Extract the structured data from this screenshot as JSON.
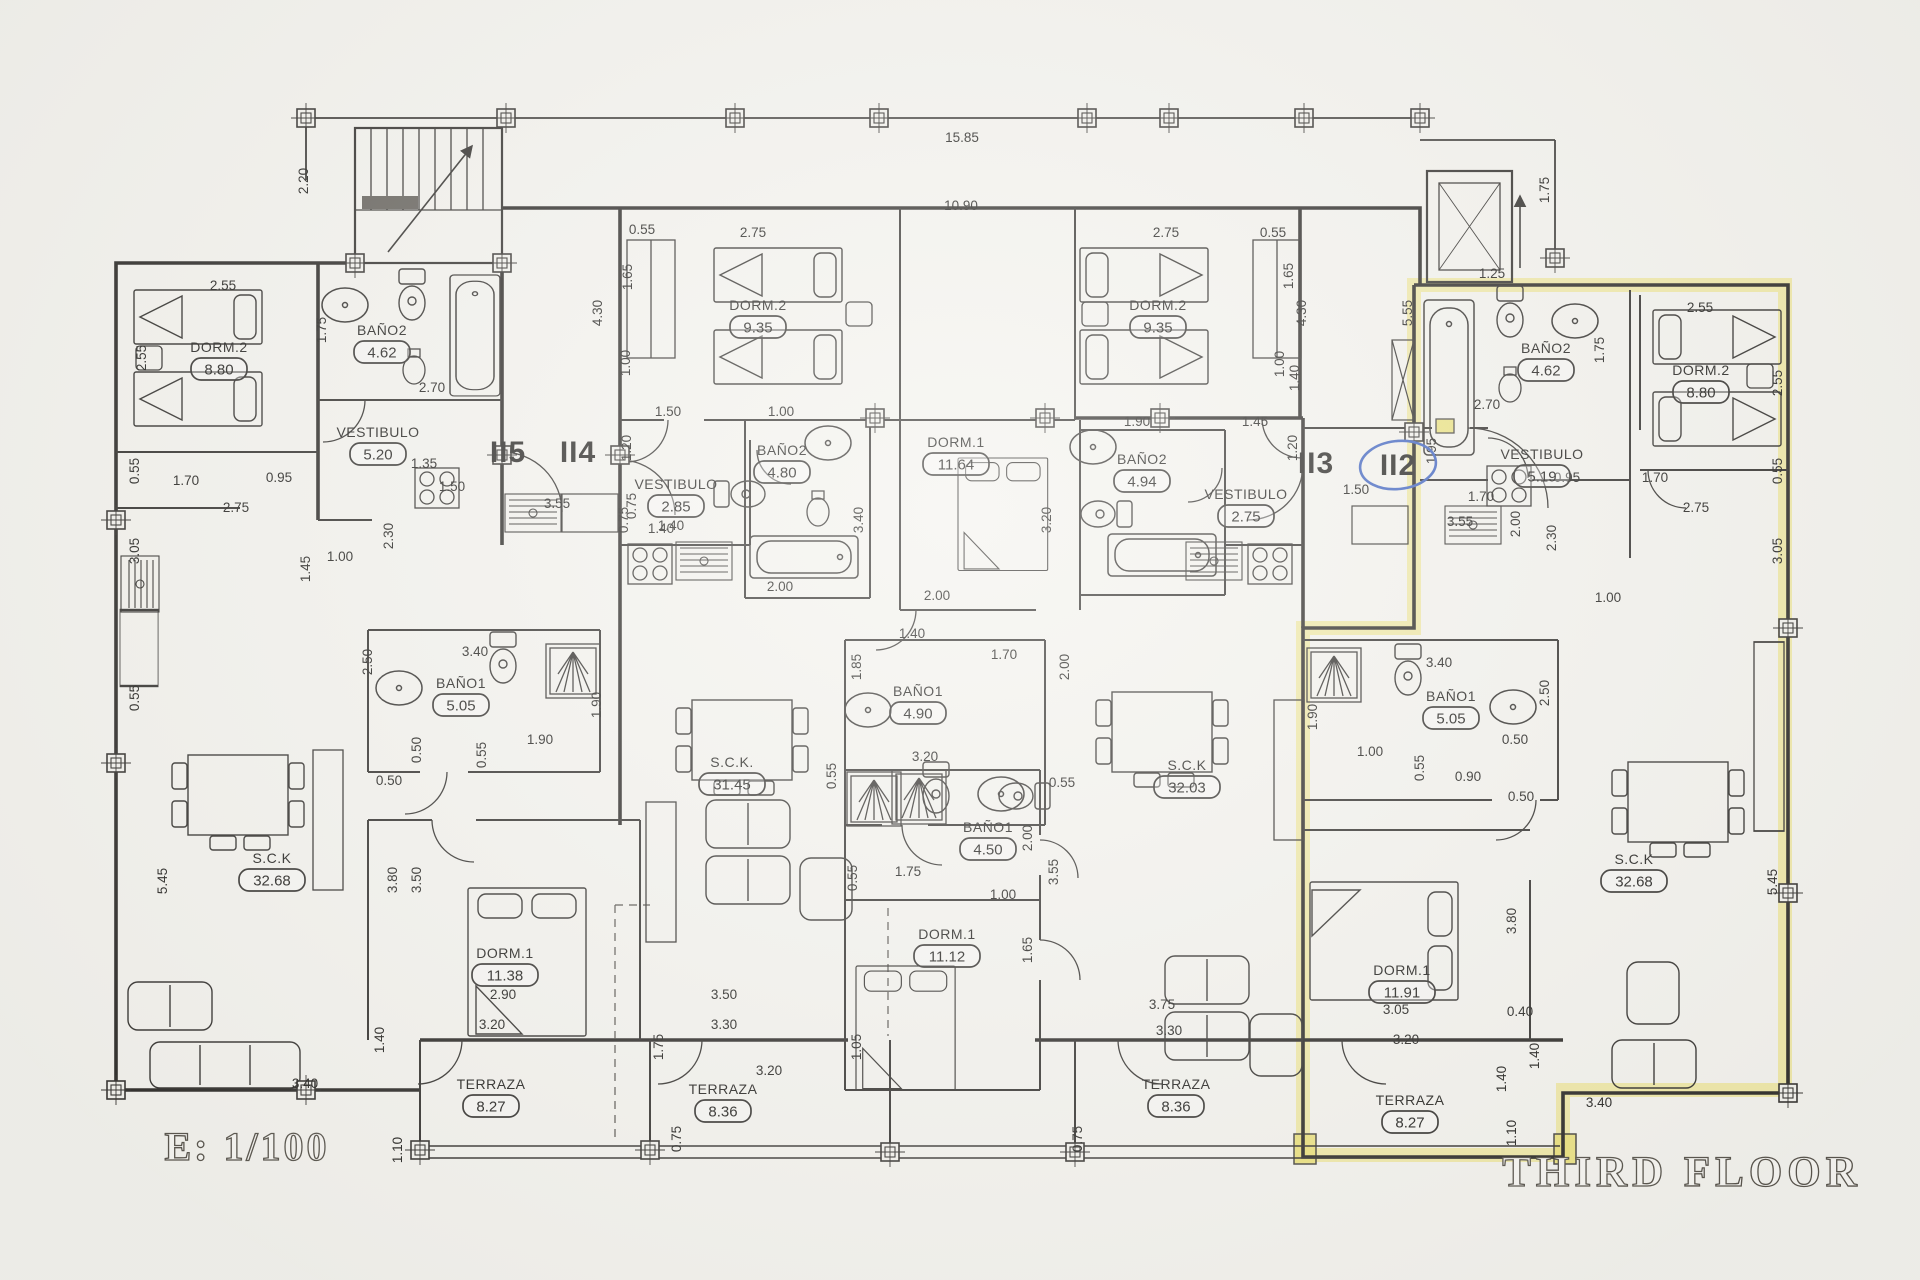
{
  "titles": {
    "scale_label": "E: 1/100",
    "floor_label": "THIRD FLOOR"
  },
  "units": [
    {
      "id": "II5",
      "x": 508,
      "y": 452,
      "circled": false
    },
    {
      "id": "II4",
      "x": 578,
      "y": 452,
      "circled": false
    },
    {
      "id": "II3",
      "x": 1316,
      "y": 463,
      "circled": false
    },
    {
      "id": "II2",
      "x": 1398,
      "y": 465,
      "circled": true
    }
  ],
  "rooms": [
    {
      "apt": "II5",
      "name": "DORM.2",
      "area": "8.80",
      "x": 219,
      "y": 348
    },
    {
      "apt": "II5",
      "name": "BAÑO2",
      "area": "4.62",
      "x": 382,
      "y": 331
    },
    {
      "apt": "II5",
      "name": "VESTIBULO",
      "area": "5.20",
      "x": 378,
      "y": 433
    },
    {
      "apt": "II5",
      "name": "BAÑO1",
      "area": "5.05",
      "x": 461,
      "y": 684
    },
    {
      "apt": "II5",
      "name": "S.C.K",
      "area": "32.68",
      "x": 272,
      "y": 859
    },
    {
      "apt": "II5",
      "name": "DORM.1",
      "area": "11.38",
      "x": 505,
      "y": 954
    },
    {
      "apt": "II5",
      "name": "TERRAZA",
      "area": "8.27",
      "x": 491,
      "y": 1085
    },
    {
      "apt": "II4",
      "name": "DORM.2",
      "area": "9.35",
      "x": 758,
      "y": 306
    },
    {
      "apt": "II4",
      "name": "VESTIBULO",
      "area": "2.85",
      "x": 676,
      "y": 485
    },
    {
      "apt": "II4",
      "name": "BAÑO2",
      "area": "4.80",
      "x": 782,
      "y": 451
    },
    {
      "apt": "II4",
      "name": "DORM.1",
      "area": "11.64",
      "x": 956,
      "y": 443
    },
    {
      "apt": "II4",
      "name": "BAÑO1",
      "area": "4.90",
      "x": 918,
      "y": 692
    },
    {
      "apt": "II4",
      "name": "S.C.K.",
      "area": "31.45",
      "x": 732,
      "y": 763
    },
    {
      "apt": "II4",
      "name": "TERRAZA",
      "area": "8.36",
      "x": 723,
      "y": 1090
    },
    {
      "apt": "II3",
      "name": "DORM.2",
      "area": "9.35",
      "x": 1158,
      "y": 306
    },
    {
      "apt": "II3",
      "name": "BAÑO2",
      "area": "4.94",
      "x": 1142,
      "y": 460
    },
    {
      "apt": "II3",
      "name": "VESTIBULO",
      "area": "2.75",
      "x": 1246,
      "y": 495
    },
    {
      "apt": "II3",
      "name": "BAÑO1",
      "area": "4.50",
      "x": 988,
      "y": 828
    },
    {
      "apt": "II3",
      "name": "DORM.1",
      "area": "11.12",
      "x": 947,
      "y": 935
    },
    {
      "apt": "II3",
      "name": "S.C.K",
      "area": "32.03",
      "x": 1187,
      "y": 766
    },
    {
      "apt": "II3",
      "name": "TERRAZA",
      "area": "8.36",
      "x": 1176,
      "y": 1085
    },
    {
      "apt": "II2",
      "name": "BAÑO2",
      "area": "4.62",
      "x": 1546,
      "y": 349
    },
    {
      "apt": "II2",
      "name": "DORM.2",
      "area": "8.80",
      "x": 1701,
      "y": 371
    },
    {
      "apt": "II2",
      "name": "VESTIBULO",
      "area": "5.19",
      "x": 1542,
      "y": 455
    },
    {
      "apt": "II2",
      "name": "BAÑO1",
      "area": "5.05",
      "x": 1451,
      "y": 697
    },
    {
      "apt": "II2",
      "name": "DORM.1",
      "area": "11.91",
      "x": 1402,
      "y": 971
    },
    {
      "apt": "II2",
      "name": "S.C.K",
      "area": "32.68",
      "x": 1634,
      "y": 860
    },
    {
      "apt": "II2",
      "name": "TERRAZA",
      "area": "8.27",
      "x": 1410,
      "y": 1101
    }
  ],
  "dimensions": [
    {
      "t": "15.85",
      "x": 962,
      "y": 138
    },
    {
      "t": "10.90",
      "x": 961,
      "y": 206
    },
    {
      "t": "2.20",
      "x": 304,
      "y": 181,
      "v": 1
    },
    {
      "t": "1.75",
      "x": 1545,
      "y": 190,
      "v": 1
    },
    {
      "t": "1.25",
      "x": 1492,
      "y": 274
    },
    {
      "t": "2.55",
      "x": 223,
      "y": 286
    },
    {
      "t": "2.55",
      "x": 142,
      "y": 358,
      "v": 1
    },
    {
      "t": "1.75",
      "x": 322,
      "y": 330,
      "v": 1
    },
    {
      "t": "2.70",
      "x": 432,
      "y": 388
    },
    {
      "t": "0.95",
      "x": 279,
      "y": 478
    },
    {
      "t": "1.70",
      "x": 186,
      "y": 481
    },
    {
      "t": "0.55",
      "x": 135,
      "y": 471,
      "v": 1
    },
    {
      "t": "2.75",
      "x": 236,
      "y": 508
    },
    {
      "t": "3.05",
      "x": 135,
      "y": 551,
      "v": 1
    },
    {
      "t": "1.45",
      "x": 306,
      "y": 569,
      "v": 1
    },
    {
      "t": "1.00",
      "x": 340,
      "y": 557
    },
    {
      "t": "0.55",
      "x": 135,
      "y": 698,
      "v": 1
    },
    {
      "t": "5.45",
      "x": 163,
      "y": 881,
      "v": 1
    },
    {
      "t": "3.40",
      "x": 305,
      "y": 1084
    },
    {
      "t": "1.10",
      "x": 398,
      "y": 1150,
      "v": 1
    },
    {
      "t": "1.40",
      "x": 380,
      "y": 1040,
      "v": 1
    },
    {
      "t": "2.30",
      "x": 389,
      "y": 536,
      "v": 1
    },
    {
      "t": "3.55",
      "x": 557,
      "y": 504
    },
    {
      "t": "0.75",
      "x": 624,
      "y": 520,
      "v": 1
    },
    {
      "t": "1.40",
      "x": 661,
      "y": 529
    },
    {
      "t": "1.35",
      "x": 424,
      "y": 464
    },
    {
      "t": "1.50",
      "x": 452,
      "y": 487
    },
    {
      "t": "2.50",
      "x": 368,
      "y": 662,
      "v": 1
    },
    {
      "t": "3.40",
      "x": 475,
      "y": 652
    },
    {
      "t": "1.90",
      "x": 597,
      "y": 705,
      "v": 1
    },
    {
      "t": "0.50",
      "x": 417,
      "y": 750,
      "v": 1
    },
    {
      "t": "1.90",
      "x": 540,
      "y": 740
    },
    {
      "t": "0.55",
      "x": 482,
      "y": 755,
      "v": 1
    },
    {
      "t": "0.50",
      "x": 389,
      "y": 781
    },
    {
      "t": "3.80",
      "x": 393,
      "y": 880,
      "v": 1
    },
    {
      "t": "3.50",
      "x": 417,
      "y": 880,
      "v": 1
    },
    {
      "t": "2.90",
      "x": 503,
      "y": 995
    },
    {
      "t": "3.20",
      "x": 492,
      "y": 1025
    },
    {
      "t": "0.55",
      "x": 642,
      "y": 230
    },
    {
      "t": "2.75",
      "x": 753,
      "y": 233
    },
    {
      "t": "1.65",
      "x": 628,
      "y": 277,
      "v": 1
    },
    {
      "t": "4.30",
      "x": 598,
      "y": 313,
      "v": 1
    },
    {
      "t": "1.00",
      "x": 626,
      "y": 363,
      "v": 1
    },
    {
      "t": "1.50",
      "x": 668,
      "y": 412
    },
    {
      "t": "1.00",
      "x": 781,
      "y": 412
    },
    {
      "t": "1.20",
      "x": 627,
      "y": 448,
      "v": 1
    },
    {
      "t": "0.75",
      "x": 632,
      "y": 506,
      "v": 1
    },
    {
      "t": "1.40",
      "x": 671,
      "y": 526
    },
    {
      "t": "2.00",
      "x": 780,
      "y": 587
    },
    {
      "t": "3.40",
      "x": 859,
      "y": 520,
      "v": 1
    },
    {
      "t": "3.20",
      "x": 1047,
      "y": 520,
      "v": 1
    },
    {
      "t": "2.00",
      "x": 937,
      "y": 596
    },
    {
      "t": "1.40",
      "x": 912,
      "y": 634
    },
    {
      "t": "1.70",
      "x": 1004,
      "y": 655
    },
    {
      "t": "1.85",
      "x": 857,
      "y": 667,
      "v": 1
    },
    {
      "t": "2.00",
      "x": 1065,
      "y": 667,
      "v": 1
    },
    {
      "t": "3.20",
      "x": 925,
      "y": 757
    },
    {
      "t": "0.55",
      "x": 832,
      "y": 776,
      "v": 1
    },
    {
      "t": "1.75",
      "x": 908,
      "y": 872
    },
    {
      "t": "3.50",
      "x": 724,
      "y": 995
    },
    {
      "t": "3.30",
      "x": 724,
      "y": 1025
    },
    {
      "t": "1.75",
      "x": 659,
      "y": 1047,
      "v": 1
    },
    {
      "t": "1.05",
      "x": 857,
      "y": 1047,
      "v": 1
    },
    {
      "t": "3.20",
      "x": 769,
      "y": 1071
    },
    {
      "t": "0.75",
      "x": 677,
      "y": 1139,
      "v": 1
    },
    {
      "t": "2.75",
      "x": 1166,
      "y": 233
    },
    {
      "t": "0.55",
      "x": 1273,
      "y": 233
    },
    {
      "t": "1.65",
      "x": 1289,
      "y": 276,
      "v": 1
    },
    {
      "t": "4.30",
      "x": 1302,
      "y": 313,
      "v": 1
    },
    {
      "t": "1.00",
      "x": 1280,
      "y": 364,
      "v": 1
    },
    {
      "t": "1.90",
      "x": 1137,
      "y": 422
    },
    {
      "t": "1.45",
      "x": 1255,
      "y": 422
    },
    {
      "t": "1.40",
      "x": 1295,
      "y": 378,
      "v": 1
    },
    {
      "t": "1.20",
      "x": 1293,
      "y": 448,
      "v": 1
    },
    {
      "t": "0.55",
      "x": 1062,
      "y": 783
    },
    {
      "t": "2.00",
      "x": 1028,
      "y": 838,
      "v": 1
    },
    {
      "t": "3.55",
      "x": 1054,
      "y": 872,
      "v": 1
    },
    {
      "t": "0.55",
      "x": 853,
      "y": 878,
      "v": 1
    },
    {
      "t": "1.00",
      "x": 1003,
      "y": 895
    },
    {
      "t": "1.65",
      "x": 1028,
      "y": 950,
      "v": 1
    },
    {
      "t": "3.75",
      "x": 1162,
      "y": 1005
    },
    {
      "t": "3.30",
      "x": 1169,
      "y": 1031
    },
    {
      "t": "0.75",
      "x": 1078,
      "y": 1139,
      "v": 1
    },
    {
      "t": "5.55",
      "x": 1408,
      "y": 313,
      "v": 1
    },
    {
      "t": "2.70",
      "x": 1487,
      "y": 405
    },
    {
      "t": "1.75",
      "x": 1600,
      "y": 350,
      "v": 1
    },
    {
      "t": "2.55",
      "x": 1700,
      "y": 308
    },
    {
      "t": "2.55",
      "x": 1778,
      "y": 383,
      "v": 1
    },
    {
      "t": "0.95",
      "x": 1567,
      "y": 478
    },
    {
      "t": "1.70",
      "x": 1655,
      "y": 478
    },
    {
      "t": "0.55",
      "x": 1778,
      "y": 471,
      "v": 1
    },
    {
      "t": "2.00",
      "x": 1516,
      "y": 524,
      "v": 1
    },
    {
      "t": "2.75",
      "x": 1696,
      "y": 508
    },
    {
      "t": "3.05",
      "x": 1778,
      "y": 551,
      "v": 1
    },
    {
      "t": "1.95",
      "x": 1432,
      "y": 451,
      "v": 1
    },
    {
      "t": "1.50",
      "x": 1356,
      "y": 490
    },
    {
      "t": "1.70",
      "x": 1481,
      "y": 497
    },
    {
      "t": "3.55",
      "x": 1460,
      "y": 522
    },
    {
      "t": "2.30",
      "x": 1552,
      "y": 538,
      "v": 1
    },
    {
      "t": "1.00",
      "x": 1608,
      "y": 598
    },
    {
      "t": "1.90",
      "x": 1313,
      "y": 717,
      "v": 1
    },
    {
      "t": "3.40",
      "x": 1439,
      "y": 663
    },
    {
      "t": "2.50",
      "x": 1545,
      "y": 693,
      "v": 1
    },
    {
      "t": "0.50",
      "x": 1515,
      "y": 740
    },
    {
      "t": "1.00",
      "x": 1370,
      "y": 752
    },
    {
      "t": "0.55",
      "x": 1420,
      "y": 768,
      "v": 1
    },
    {
      "t": "0.90",
      "x": 1468,
      "y": 777
    },
    {
      "t": "0.50",
      "x": 1521,
      "y": 797
    },
    {
      "t": "3.80",
      "x": 1512,
      "y": 921,
      "v": 1
    },
    {
      "t": "0.40",
      "x": 1520,
      "y": 1012
    },
    {
      "t": "3.05",
      "x": 1396,
      "y": 1010
    },
    {
      "t": "3.20",
      "x": 1406,
      "y": 1040
    },
    {
      "t": "1.40",
      "x": 1535,
      "y": 1056,
      "v": 1
    },
    {
      "t": "1.40",
      "x": 1502,
      "y": 1079,
      "v": 1
    },
    {
      "t": "3.40",
      "x": 1599,
      "y": 1103
    },
    {
      "t": "5.45",
      "x": 1773,
      "y": 882,
      "v": 1
    },
    {
      "t": "1.10",
      "x": 1512,
      "y": 1133,
      "v": 1
    }
  ],
  "colors": {
    "highlight": "#ece27d",
    "pen_blue": "#4a6cc3",
    "ink": "#3a3835",
    "paper": "#f4f3ee"
  }
}
